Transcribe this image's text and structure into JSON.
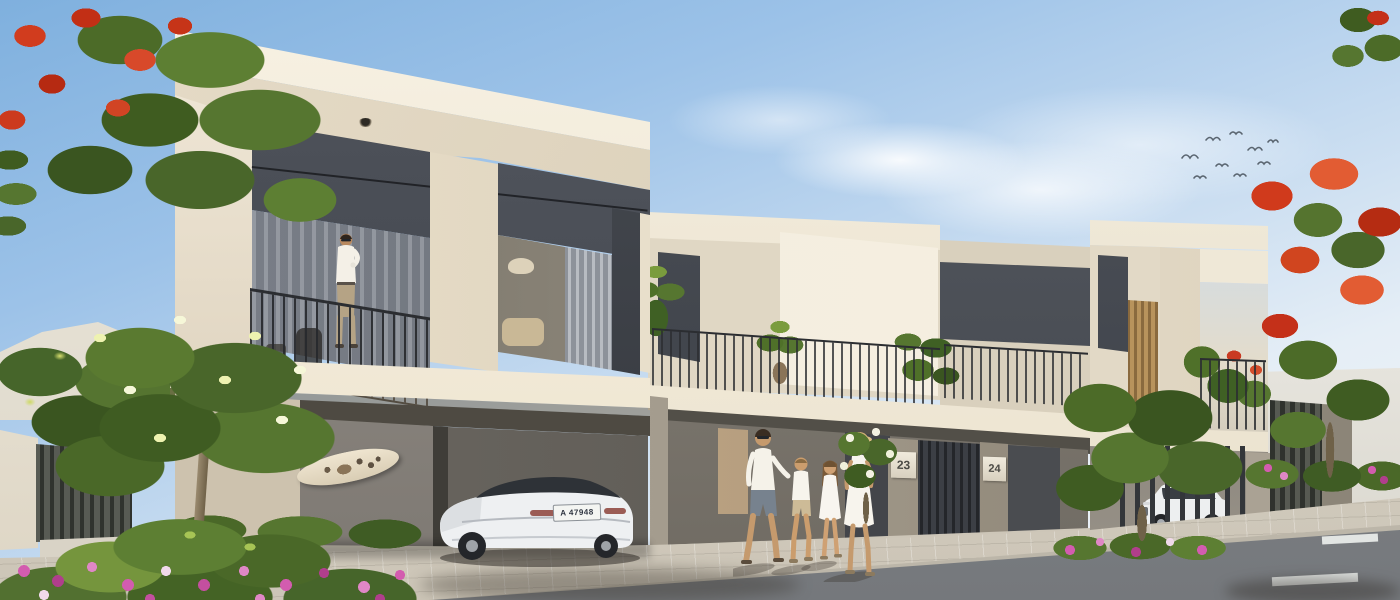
{
  "scene": {
    "description": "Sunny architectural rendering of modern beige two-storey townhouses with carports and balconies; a man stands on the left balcony, a family of four walks on the sidewalk, a white sedan is parked under the carport and a white SUV sits behind a slatted screen; lush trees with red, pink and yellow flowers frame the street.",
    "house_numbers": {
      "unit_left": "23",
      "unit_right": "24"
    },
    "vehicles": {
      "sedan": "white electric sedan",
      "sedan_plate": "A 47948",
      "suv": "white suv"
    },
    "objects": [
      "man-on-balcony",
      "family-of-four",
      "white-sedan",
      "white-suv",
      "surfboard",
      "balcony-railing",
      "ceiling-lights",
      "flame-tree",
      "frangipani-tree",
      "flower-bed",
      "hedge",
      "birds",
      "road-markings"
    ],
    "palette": {
      "sky_top": "#7fb0de",
      "sky_horizon": "#f2f5f8",
      "wall_bright": "#f6f0e1",
      "wall_cream": "#e3dac8",
      "wall_shaded": "#bdb3a1",
      "panel_dark": "#50545c",
      "glass_dark": "#2e3237",
      "railing": "#2b2d31",
      "slab_white": "#f8f2e4",
      "pavement": "#d8d2c6",
      "road": "#83868a",
      "foliage_dark": "#3f5c20",
      "foliage_mid": "#567630",
      "foliage_light": "#8aa945",
      "flower_red": "#d03a1c",
      "flower_pink": "#d35caf",
      "flower_yellow": "#eef2b0",
      "skin": "#c59a6d",
      "wood_warm": "#b8935c"
    }
  }
}
